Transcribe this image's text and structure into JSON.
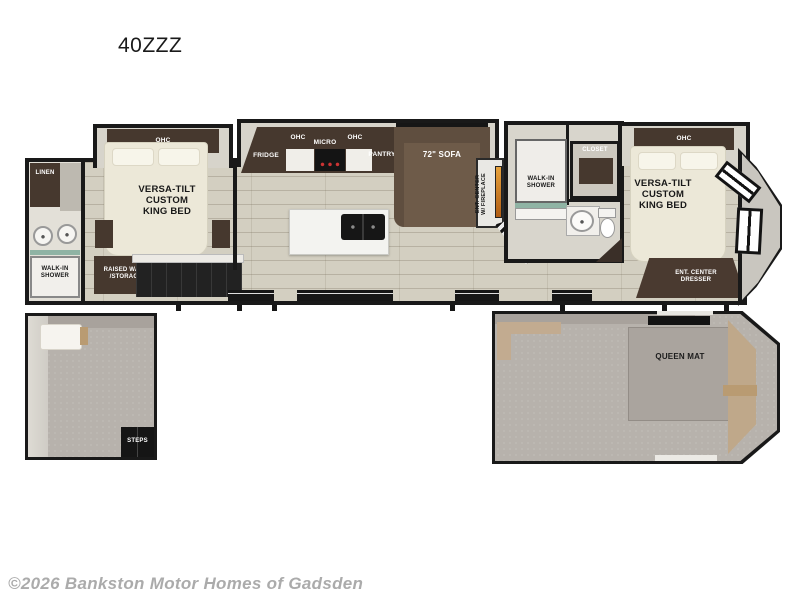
{
  "title": "40ZZZ",
  "watermark": "©2026 Bankston Motor Homes of Gadsden",
  "colors": {
    "wall": "#191919",
    "wood_floor": "#d3cfc1",
    "carpet": "#b7b2ac",
    "dark_cabinet": "#46382e",
    "sofa_brown": "#6e5b49",
    "bed_cream": "#ece8d8",
    "shower_glass_teal": "#8fb3a4",
    "fireplace_amber": "#d98a2b"
  },
  "upper": {
    "front_bedroom": {
      "ohc": "OHC",
      "bed": "VERSA-TILT\nCUSTOM\nKING BED",
      "storage": "RAISED WARD\n/STORAGE"
    },
    "left_bath": {
      "linen": "LINEN",
      "shower": "WALK-IN\nSHOWER"
    },
    "kitchen": {
      "fridge": "FRIDGE",
      "ohc_left": "OHC",
      "micro": "MICRO",
      "ohc_right": "OHC",
      "pantry": "PANTRY"
    },
    "living": {
      "sofa": "72\" SOFA",
      "ent_center": "ENT. CENTER\nW/ FIREPLACE"
    },
    "mid_bath": {
      "shower": "WALK-IN\nSHOWER",
      "closet": "CLOSET"
    },
    "rear_bedroom": {
      "ohc": "OHC",
      "bed": "VERSA-TILT\nCUSTOM\nKING BED",
      "dresser": "ENT. CENTER\nDRESSER"
    }
  },
  "lower": {
    "left_loft": {
      "steps": "STEPS"
    },
    "right_loft": {
      "mat": "QUEEN MAT"
    }
  }
}
